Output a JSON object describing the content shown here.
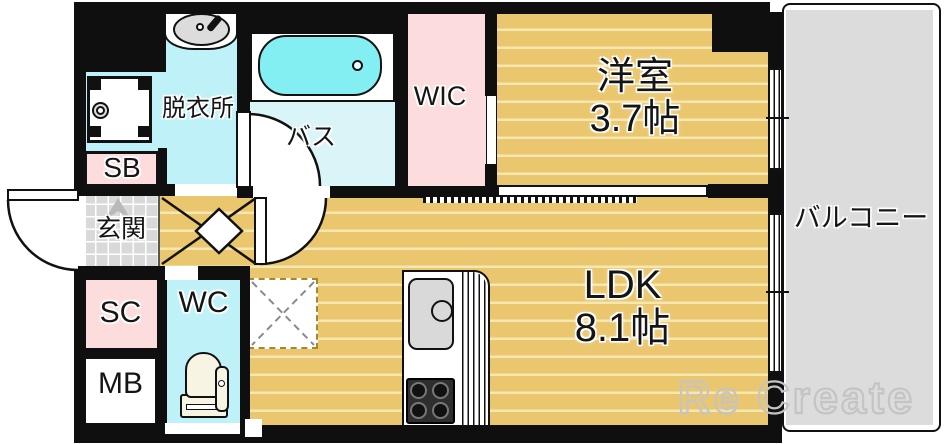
{
  "plan_title": "1LDK floor plan",
  "rooms": {
    "dressing": {
      "label": "脱衣所"
    },
    "bath": {
      "label": "バス"
    },
    "wic": {
      "label": "WIC"
    },
    "western": {
      "label": "洋室",
      "size": "3.7帖"
    },
    "ldk": {
      "label": "LDK",
      "size": "8.1帖"
    },
    "balcony": {
      "label": "バルコニー"
    },
    "entrance": {
      "label": "玄関"
    },
    "shoe_box": {
      "label": "SB"
    },
    "shoe_closet": {
      "label": "SC"
    },
    "meter_box": {
      "label": "MB"
    },
    "toilet": {
      "label": "WC"
    }
  },
  "watermark": "Re Create",
  "icons": [
    "washbasin-icon",
    "washing-machine-icon",
    "bathtub-icon",
    "toilet-icon",
    "kitchen-sink-icon",
    "stove-icon",
    "refrigerator-space",
    "door-swing-arc"
  ],
  "colors": {
    "wall": "#0f0f0f",
    "floor_wood": "#eac76f",
    "floor_wood_stripe": "#f5e7b1",
    "room_pink": "#fcdcdc",
    "room_cyan": "#bef2f8",
    "bath_floor": "#d9f5f8",
    "bathtub": "#83eff3",
    "entrance_tile": "#d9d9d9",
    "balcony_gray": "#dcdcdc",
    "watermark_gray": "#c4c4c4"
  }
}
